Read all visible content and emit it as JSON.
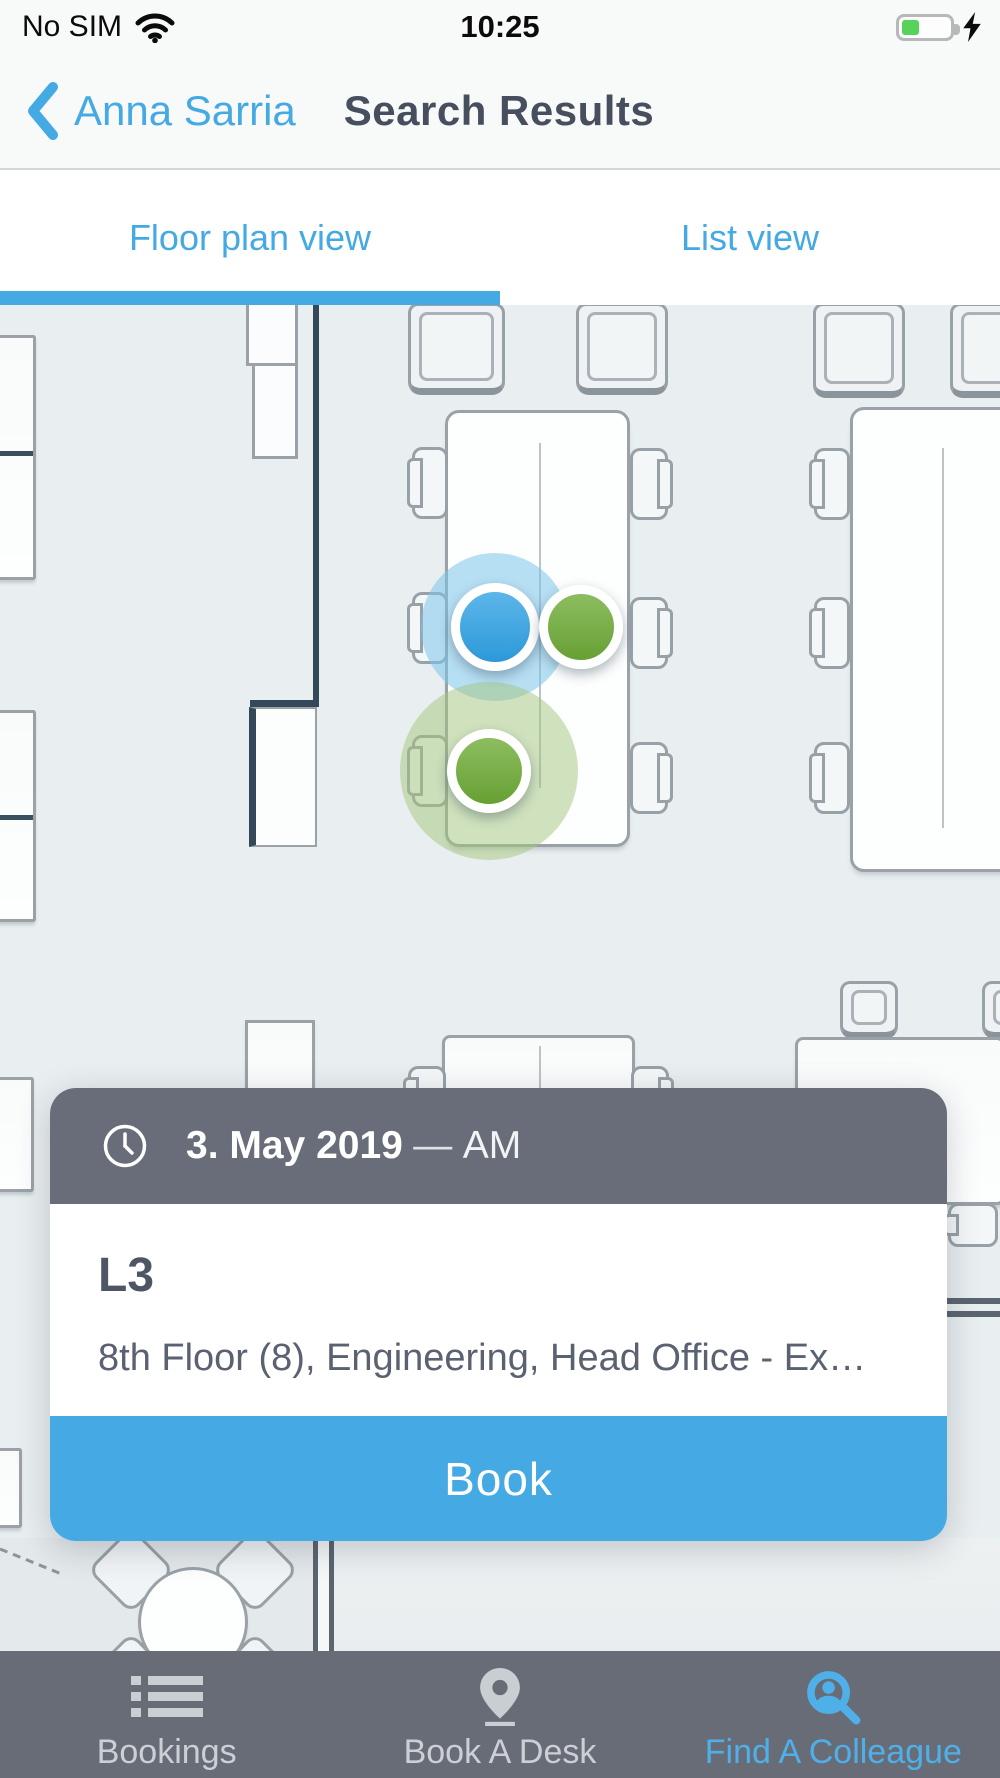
{
  "status_bar": {
    "carrier": "No SIM",
    "time": "10:25"
  },
  "nav": {
    "back_label": "Anna Sarria",
    "title": "Search Results"
  },
  "tabs": {
    "floor_plan": "Floor plan view",
    "list": "List view"
  },
  "booking_card": {
    "date": "3. May 2019",
    "dash": "—",
    "period": "AM",
    "desk_name": "L3",
    "location": "8th Floor (8), Engineering, Head Office - Ex…",
    "book_button": "Book"
  },
  "tab_bar": {
    "bookings": "Bookings",
    "book_a_desk": "Book A Desk",
    "find_a_colleague": "Find A Colleague"
  },
  "floor_plan": {
    "markers": [
      {
        "x": 495,
        "y": 627,
        "color": "blue",
        "r": 44,
        "halo": true,
        "halo_r": 74,
        "status": "selected-colleague"
      },
      {
        "x": 581,
        "y": 627,
        "color": "green",
        "r": 42,
        "halo": false,
        "halo_r": 0,
        "status": "colleague"
      },
      {
        "x": 489,
        "y": 771,
        "color": "green",
        "r": 42,
        "halo": true,
        "halo_r": 89,
        "status": "colleague"
      }
    ]
  },
  "colors": {
    "accent-blue": "#45a9e3",
    "marker-blue": "#3da2de",
    "marker-green": "#7dae4b",
    "header-gray": "#686d79",
    "tabbar-gray": "#676c77",
    "inactive-gray": "#ccd0d5",
    "title-dark": "#474e5d",
    "floor-bg": "#e9eef0",
    "battery-green": "#57d35c"
  }
}
